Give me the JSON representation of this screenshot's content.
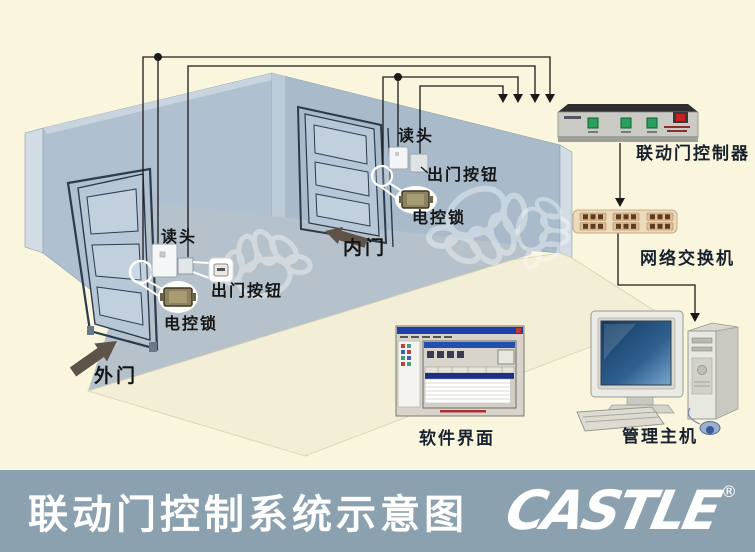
{
  "scene": {
    "outer_door": {
      "label": "外门",
      "reader_label": "读头",
      "exit_button_label": "出门按钮",
      "lock_label": "电控锁"
    },
    "inner_door": {
      "label": "内门",
      "reader_label": "读头",
      "exit_button_label": "出门按钮",
      "lock_label": "电控锁"
    },
    "controller_label": "联动门控制器",
    "switch_label": "网络交换机",
    "software_label": "软件界面",
    "host_label": "管理主机"
  },
  "title_bar": {
    "title": "联动门控制系统示意图",
    "logo": "CASTLE",
    "reg": "®"
  },
  "colors": {
    "background": "#FAF6DE",
    "bar": "#8CA1B0",
    "wall": "#B0C0D1",
    "wall_inner": "#B6C2CB",
    "wall_back": "#A9BBCA",
    "floor": "#F3EED6",
    "wire": "#1A1A1A",
    "arrow": "#5D5348",
    "button_green": "#2AA05C",
    "switch_body": "#EDD9BB"
  }
}
